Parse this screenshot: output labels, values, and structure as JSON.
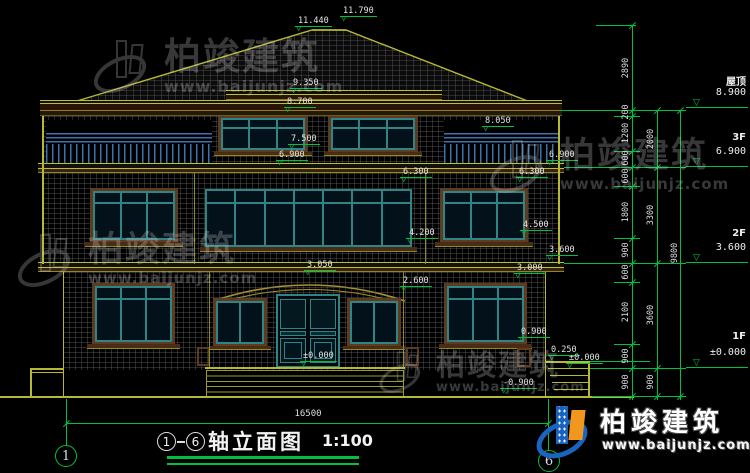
{
  "drawing": {
    "title": {
      "axis_start": "1",
      "axis_end": "6",
      "name": "轴立面图",
      "scale": "1:100"
    },
    "axis_bubbles": {
      "left": "1",
      "right": "6"
    },
    "overall_width_mm": "16500",
    "floor_levels": [
      {
        "label": "屋顶",
        "elevation": "8.900"
      },
      {
        "label": "3F",
        "elevation": "6.900"
      },
      {
        "label": "2F",
        "elevation": "3.600"
      },
      {
        "label": "1F",
        "elevation": "±0.000"
      }
    ],
    "elevation_marks": [
      "11.790",
      "11.440",
      "9.350",
      "8.700",
      "8.050",
      "7.500",
      "6.900",
      "6.900",
      "6.300",
      "6.300",
      "4.500",
      "4.200",
      "3.050",
      "2.600",
      "3.600",
      "3.000",
      "0.900",
      "0.250",
      "±0.000",
      "±0.000",
      "-0.900"
    ],
    "dim_chain_detail": [
      "2890",
      "200",
      "1200",
      "600",
      "600",
      "1800",
      "900",
      "600",
      "2100",
      "900",
      "900"
    ],
    "dim_chain_floors": [
      "2000",
      "3300",
      "3600",
      "900"
    ],
    "dim_chain_total": [
      "9800"
    ]
  },
  "brand": {
    "name": "柏竣建筑",
    "url": "www.baijunjz.com"
  },
  "watermark": {
    "name": "柏竣建筑",
    "url": "www.baijunjz.com"
  },
  "colors": {
    "background": "#000000",
    "line_yellow": "#b8b832",
    "line_green": "#00c040",
    "window_teal": "#2f8585",
    "frame_brown": "#5e3a1e",
    "railing_blue": "#3d72aa",
    "brand_blue": "#1a64c0",
    "brand_orange": "#f2971e"
  }
}
